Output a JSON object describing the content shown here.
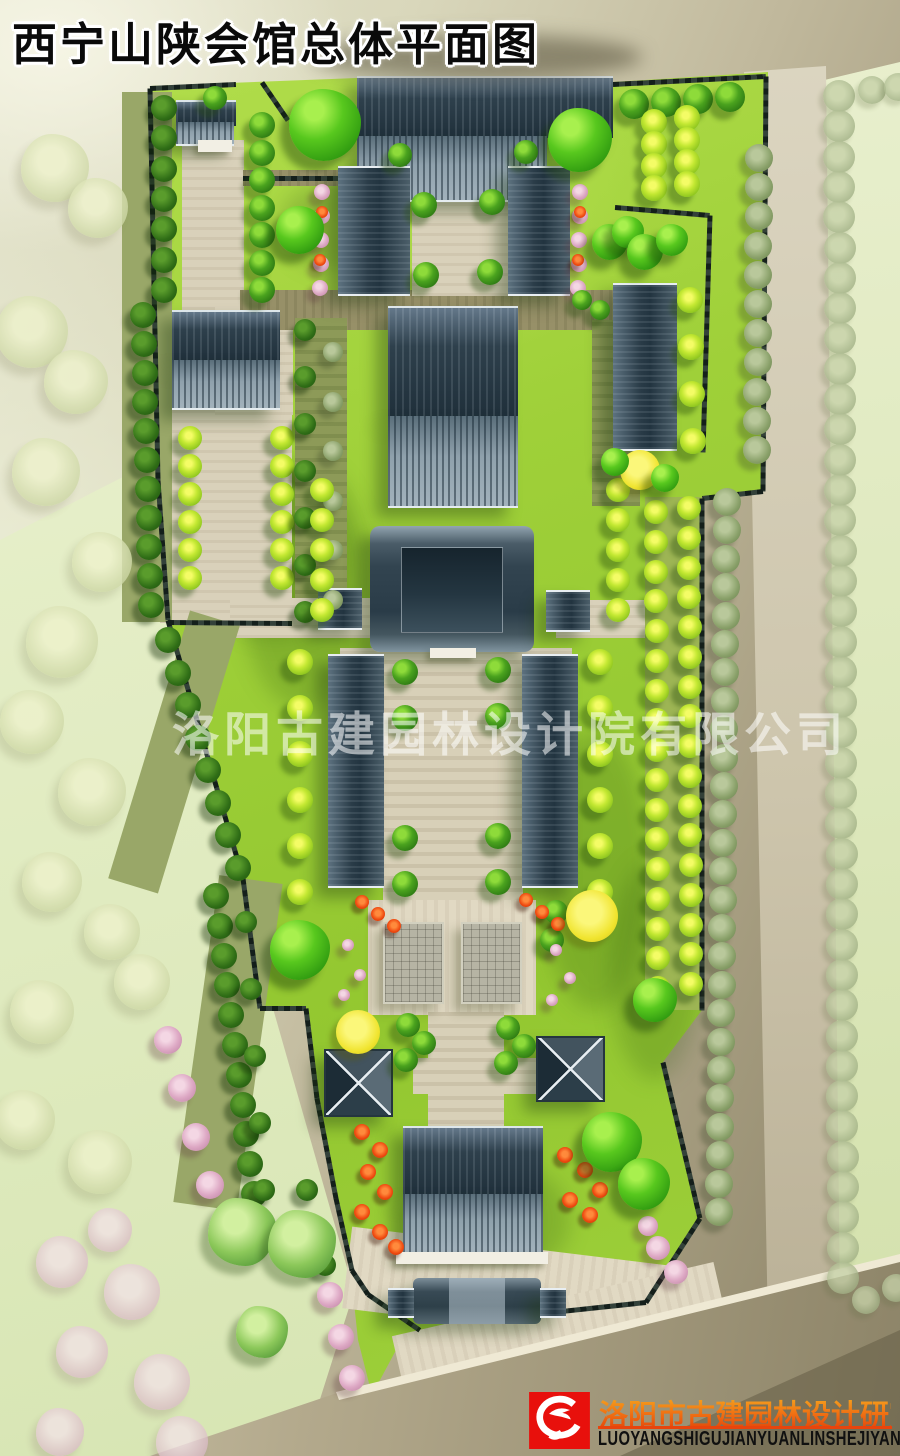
{
  "title": "西宁山陕会馆总体平面图",
  "watermark": "洛阳古建园林设计院有限公司",
  "publisher": {
    "name_cn": "洛阳市古建园林设计研究院",
    "name_latin": "LUOYANGSHIGUJIANYUANLINSHEJIYANJIUYUAN"
  },
  "legend_colors": {
    "lawn": "#9fd039",
    "roof_dark": "#2e404c",
    "roof_light": "#93a5b0",
    "path_beige": "#d9d1ba",
    "road_tan": "#b3a98c",
    "tree_green": "#4aa21e",
    "tree_lime": "#c3e832",
    "flower_pink": "#dda8c4",
    "flower_red": "#ef4a10",
    "logo_red": "#e8100c",
    "watermark_white": "rgba(255,255,255,0.55)"
  },
  "plan": {
    "site_polygon": [
      [
        150,
        86
      ],
      [
        357,
        78
      ],
      [
        613,
        82
      ],
      [
        768,
        72
      ],
      [
        765,
        490
      ],
      [
        702,
        497
      ],
      [
        702,
        1010
      ],
      [
        663,
        1062
      ],
      [
        700,
        1218
      ],
      [
        646,
        1302
      ],
      [
        552,
        1312
      ],
      [
        470,
        1318
      ],
      [
        420,
        1330
      ],
      [
        395,
        1352
      ],
      [
        372,
        1395
      ],
      [
        358,
        1340
      ],
      [
        350,
        1265
      ],
      [
        336,
        1197
      ],
      [
        317,
        1097
      ],
      [
        306,
        1007
      ],
      [
        260,
        1007
      ],
      [
        243,
        878
      ],
      [
        168,
        620
      ],
      [
        158,
        480
      ]
    ],
    "shades": [
      [
        240,
        460,
        130,
        250
      ],
      [
        540,
        730,
        110,
        280
      ],
      [
        280,
        180,
        110,
        90
      ],
      [
        610,
        860,
        90,
        220
      ],
      [
        420,
        1160,
        150,
        120
      ],
      [
        200,
        470,
        150,
        170
      ]
    ],
    "paths": [
      [
        182,
        140,
        62,
        270,
        "beige",
        0
      ],
      [
        160,
        405,
        132,
        218,
        "beige",
        0
      ],
      [
        215,
        305,
        78,
        110,
        "beige",
        0
      ],
      [
        243,
        170,
        170,
        16,
        "olive",
        0
      ],
      [
        240,
        290,
        390,
        40,
        "olive",
        0
      ],
      [
        412,
        132,
        118,
        164,
        "beige",
        0
      ],
      [
        295,
        318,
        52,
        300,
        "olive2",
        0
      ],
      [
        592,
        320,
        48,
        186,
        "olive2",
        0
      ],
      [
        230,
        598,
        140,
        40,
        "beige",
        0
      ],
      [
        556,
        600,
        108,
        38,
        "beige",
        0
      ],
      [
        340,
        648,
        232,
        46,
        "beige",
        0
      ],
      [
        383,
        660,
        140,
        265,
        "axis",
        0
      ],
      [
        368,
        900,
        168,
        115,
        "plaza",
        0
      ],
      [
        428,
        1012,
        76,
        122,
        "axis",
        0
      ],
      [
        413,
        1058,
        165,
        36,
        "axis",
        0
      ],
      [
        645,
        497,
        57,
        513,
        "verge",
        0
      ],
      [
        122,
        92,
        50,
        530,
        "verge2",
        0
      ],
      [
        148,
        612,
        52,
        280,
        "verge2",
        17
      ],
      [
        196,
        878,
        64,
        330,
        "verge2",
        8
      ],
      [
        346,
        1246,
        322,
        82,
        "plaza",
        7
      ],
      [
        398,
        1298,
        330,
        92,
        "plaza",
        -13
      ]
    ],
    "walls": [
      [
        150,
        86,
        158,
        478
      ],
      [
        158,
        478,
        168,
        618
      ],
      [
        168,
        618,
        243,
        876
      ],
      [
        243,
        876,
        260,
        1006
      ],
      [
        260,
        1006,
        306,
        1006
      ],
      [
        306,
        1006,
        317,
        1096
      ],
      [
        317,
        1096,
        336,
        1196
      ],
      [
        336,
        1196,
        352,
        1268
      ],
      [
        352,
        1268,
        368,
        1292
      ],
      [
        368,
        1292,
        420,
        1328
      ],
      [
        613,
        82,
        766,
        74
      ],
      [
        766,
        74,
        763,
        489
      ],
      [
        763,
        489,
        702,
        496
      ],
      [
        702,
        496,
        702,
        1008
      ],
      [
        663,
        1060,
        700,
        1216
      ],
      [
        700,
        1216,
        646,
        1300
      ],
      [
        646,
        1300,
        552,
        1310
      ],
      [
        615,
        205,
        710,
        213
      ],
      [
        710,
        213,
        703,
        450
      ],
      [
        168,
        620,
        292,
        621
      ],
      [
        243,
        176,
        412,
        176
      ],
      [
        150,
        86,
        236,
        82
      ],
      [
        262,
        80,
        288,
        118
      ]
    ],
    "buildings": [
      [
        176,
        100,
        60,
        24,
        "dh"
      ],
      [
        176,
        122,
        58,
        22,
        "sh"
      ],
      [
        198,
        140,
        34,
        12,
        "terr"
      ],
      [
        357,
        76,
        256,
        60,
        "dh"
      ],
      [
        357,
        136,
        190,
        64,
        "sh"
      ],
      [
        338,
        166,
        72,
        126,
        "v"
      ],
      [
        508,
        166,
        62,
        126,
        "v"
      ],
      [
        388,
        306,
        130,
        110,
        "dh"
      ],
      [
        388,
        416,
        130,
        90,
        "sh"
      ],
      [
        613,
        283,
        64,
        164,
        "v"
      ],
      [
        172,
        310,
        108,
        50,
        "dh"
      ],
      [
        172,
        360,
        108,
        48,
        "sh"
      ],
      [
        370,
        526,
        164,
        126,
        "main"
      ],
      [
        318,
        588,
        44,
        38,
        "v"
      ],
      [
        546,
        590,
        44,
        38,
        "v"
      ],
      [
        328,
        654,
        56,
        230,
        "v"
      ],
      [
        522,
        654,
        56,
        230,
        "v"
      ],
      [
        383,
        922,
        57,
        78,
        "plat"
      ],
      [
        461,
        922,
        57,
        78,
        "plat"
      ],
      [
        324,
        1049,
        65,
        64,
        "pav"
      ],
      [
        536,
        1036,
        65,
        62,
        "pav"
      ],
      [
        403,
        1126,
        140,
        68,
        "dh"
      ],
      [
        403,
        1194,
        140,
        58,
        "sh"
      ],
      [
        396,
        1252,
        152,
        12,
        "terr"
      ],
      [
        413,
        1278,
        128,
        46,
        "gate"
      ],
      [
        388,
        1288,
        26,
        26,
        "v"
      ],
      [
        540,
        1288,
        26,
        26,
        "v"
      ],
      [
        430,
        648,
        46,
        10,
        "terr"
      ]
    ],
    "tree_rows": [
      [
        839,
        96,
        843,
        1278,
        40,
        "f",
        16
      ],
      [
        872,
        90,
        898,
        87,
        2,
        "f",
        14
      ],
      [
        866,
        1300,
        896,
        1288,
        2,
        "f",
        14
      ],
      [
        759,
        158,
        757,
        450,
        11,
        "s",
        14
      ],
      [
        727,
        502,
        719,
        1212,
        26,
        "s",
        14
      ],
      [
        164,
        108,
        164,
        290,
        7,
        "d",
        13
      ],
      [
        143,
        315,
        151,
        605,
        11,
        "d",
        13
      ],
      [
        168,
        640,
        238,
        868,
        8,
        "d",
        13
      ],
      [
        216,
        896,
        254,
        1194,
        11,
        "d",
        13
      ],
      [
        246,
        922,
        264,
        1190,
        5,
        "d",
        11
      ],
      [
        634,
        104,
        730,
        97,
        4,
        "g",
        15
      ],
      [
        654,
        122,
        654,
        188,
        4,
        "l",
        13
      ],
      [
        687,
        118,
        687,
        184,
        4,
        "l",
        13
      ],
      [
        690,
        300,
        693,
        441,
        4,
        "l",
        13
      ],
      [
        656,
        512,
        658,
        988,
        17,
        "l",
        12
      ],
      [
        689,
        508,
        691,
        984,
        17,
        "l",
        12
      ],
      [
        262,
        125,
        262,
        290,
        7,
        "g",
        13
      ],
      [
        190,
        438,
        190,
        578,
        6,
        "l",
        12
      ],
      [
        282,
        438,
        282,
        578,
        6,
        "l",
        12
      ],
      [
        305,
        330,
        305,
        612,
        7,
        "d",
        11
      ],
      [
        333,
        352,
        333,
        600,
        6,
        "s",
        10
      ],
      [
        322,
        192,
        320,
        288,
        5,
        "p",
        8
      ],
      [
        580,
        192,
        578,
        288,
        5,
        "p",
        8
      ],
      [
        322,
        490,
        322,
        610,
        5,
        "l",
        12
      ],
      [
        618,
        490,
        618,
        610,
        5,
        "l",
        12
      ],
      [
        300,
        662,
        300,
        892,
        6,
        "l",
        13
      ],
      [
        600,
        662,
        600,
        892,
        6,
        "l",
        13
      ],
      [
        405,
        672,
        405,
        718,
        2,
        "g",
        13
      ],
      [
        498,
        670,
        498,
        716,
        2,
        "g",
        13
      ],
      [
        405,
        838,
        405,
        884,
        2,
        "g",
        13
      ],
      [
        498,
        836,
        498,
        882,
        2,
        "g",
        13
      ],
      [
        168,
        1040,
        210,
        1185,
        4,
        "p",
        14
      ],
      [
        330,
        1295,
        352,
        1378,
        3,
        "p",
        13
      ],
      [
        307,
        1190,
        325,
        1265,
        3,
        "d",
        11
      ],
      [
        556,
        912,
        552,
        940,
        2,
        "g",
        12
      ]
    ],
    "trees": [
      [
        215,
        98,
        12,
        "g"
      ],
      [
        400,
        155,
        12,
        "g"
      ],
      [
        526,
        152,
        12,
        "g"
      ],
      [
        424,
        205,
        13,
        "g"
      ],
      [
        492,
        202,
        13,
        "g"
      ],
      [
        426,
        275,
        13,
        "g"
      ],
      [
        490,
        272,
        13,
        "g"
      ],
      [
        408,
        1025,
        12,
        "g"
      ],
      [
        424,
        1043,
        12,
        "g"
      ],
      [
        406,
        1060,
        12,
        "g"
      ],
      [
        508,
        1028,
        12,
        "g"
      ],
      [
        524,
        1046,
        12,
        "g"
      ],
      [
        506,
        1063,
        12,
        "g"
      ],
      [
        582,
        300,
        10,
        "g"
      ],
      [
        600,
        310,
        10,
        "g"
      ],
      [
        322,
        212,
        6,
        "r"
      ],
      [
        320,
        260,
        6,
        "r"
      ],
      [
        580,
        212,
        6,
        "r"
      ],
      [
        578,
        260,
        6,
        "r"
      ],
      [
        362,
        1132,
        8,
        "r"
      ],
      [
        380,
        1150,
        8,
        "r"
      ],
      [
        368,
        1172,
        8,
        "r"
      ],
      [
        385,
        1192,
        8,
        "r"
      ],
      [
        362,
        1212,
        8,
        "r"
      ],
      [
        380,
        1232,
        8,
        "r"
      ],
      [
        396,
        1247,
        8,
        "r"
      ],
      [
        565,
        1155,
        8,
        "r"
      ],
      [
        585,
        1170,
        8,
        "r"
      ],
      [
        600,
        1190,
        8,
        "r"
      ],
      [
        570,
        1200,
        8,
        "r"
      ],
      [
        590,
        1215,
        8,
        "r"
      ],
      [
        362,
        902,
        7,
        "r"
      ],
      [
        378,
        914,
        7,
        "r"
      ],
      [
        394,
        926,
        7,
        "r"
      ],
      [
        526,
        900,
        7,
        "r"
      ],
      [
        542,
        912,
        7,
        "r"
      ],
      [
        558,
        924,
        7,
        "r"
      ],
      [
        348,
        945,
        6,
        "p"
      ],
      [
        360,
        975,
        6,
        "p"
      ],
      [
        344,
        995,
        6,
        "p"
      ],
      [
        556,
        950,
        6,
        "p"
      ],
      [
        570,
        978,
        6,
        "p"
      ],
      [
        552,
        1000,
        6,
        "p"
      ],
      [
        658,
        1248,
        12,
        "p"
      ],
      [
        676,
        1272,
        12,
        "p"
      ],
      [
        648,
        1226,
        10,
        "p"
      ],
      [
        358,
        1032,
        22,
        "y"
      ],
      [
        640,
        470,
        20,
        "y"
      ],
      [
        592,
        916,
        26,
        "y"
      ],
      [
        325,
        125,
        36,
        "b"
      ],
      [
        300,
        230,
        24,
        "b"
      ],
      [
        580,
        140,
        32,
        "b"
      ],
      [
        610,
        242,
        18,
        "b"
      ],
      [
        628,
        232,
        16,
        "b"
      ],
      [
        645,
        252,
        18,
        "b"
      ],
      [
        672,
        240,
        16,
        "b"
      ],
      [
        300,
        950,
        30,
        "b"
      ],
      [
        612,
        1142,
        30,
        "b"
      ],
      [
        644,
        1184,
        26,
        "b"
      ],
      [
        655,
        1000,
        22,
        "b"
      ],
      [
        615,
        462,
        14,
        "b"
      ],
      [
        665,
        478,
        14,
        "b"
      ],
      [
        242,
        1232,
        34,
        "h"
      ],
      [
        302,
        1244,
        34,
        "h"
      ],
      [
        262,
        1332,
        26,
        "h"
      ],
      [
        62,
        1262,
        26,
        "cp"
      ],
      [
        132,
        1292,
        28,
        "cp"
      ],
      [
        82,
        1352,
        26,
        "cp"
      ],
      [
        162,
        1382,
        28,
        "cp"
      ],
      [
        60,
        1432,
        24,
        "cp"
      ],
      [
        182,
        1442,
        26,
        "cp"
      ],
      [
        110,
        1230,
        22,
        "cp"
      ],
      [
        55,
        168,
        34,
        "c"
      ],
      [
        98,
        208,
        30,
        "c"
      ],
      [
        32,
        332,
        36,
        "c"
      ],
      [
        76,
        382,
        32,
        "c"
      ],
      [
        46,
        472,
        34,
        "c"
      ],
      [
        102,
        562,
        30,
        "c"
      ],
      [
        62,
        642,
        36,
        "c"
      ],
      [
        32,
        722,
        32,
        "c"
      ],
      [
        92,
        792,
        34,
        "c"
      ],
      [
        52,
        882,
        30,
        "c"
      ],
      [
        112,
        932,
        28,
        "c"
      ],
      [
        42,
        1012,
        32,
        "c"
      ],
      [
        142,
        982,
        28,
        "c"
      ],
      [
        25,
        1120,
        30,
        "c"
      ],
      [
        100,
        1162,
        32,
        "c"
      ]
    ]
  }
}
